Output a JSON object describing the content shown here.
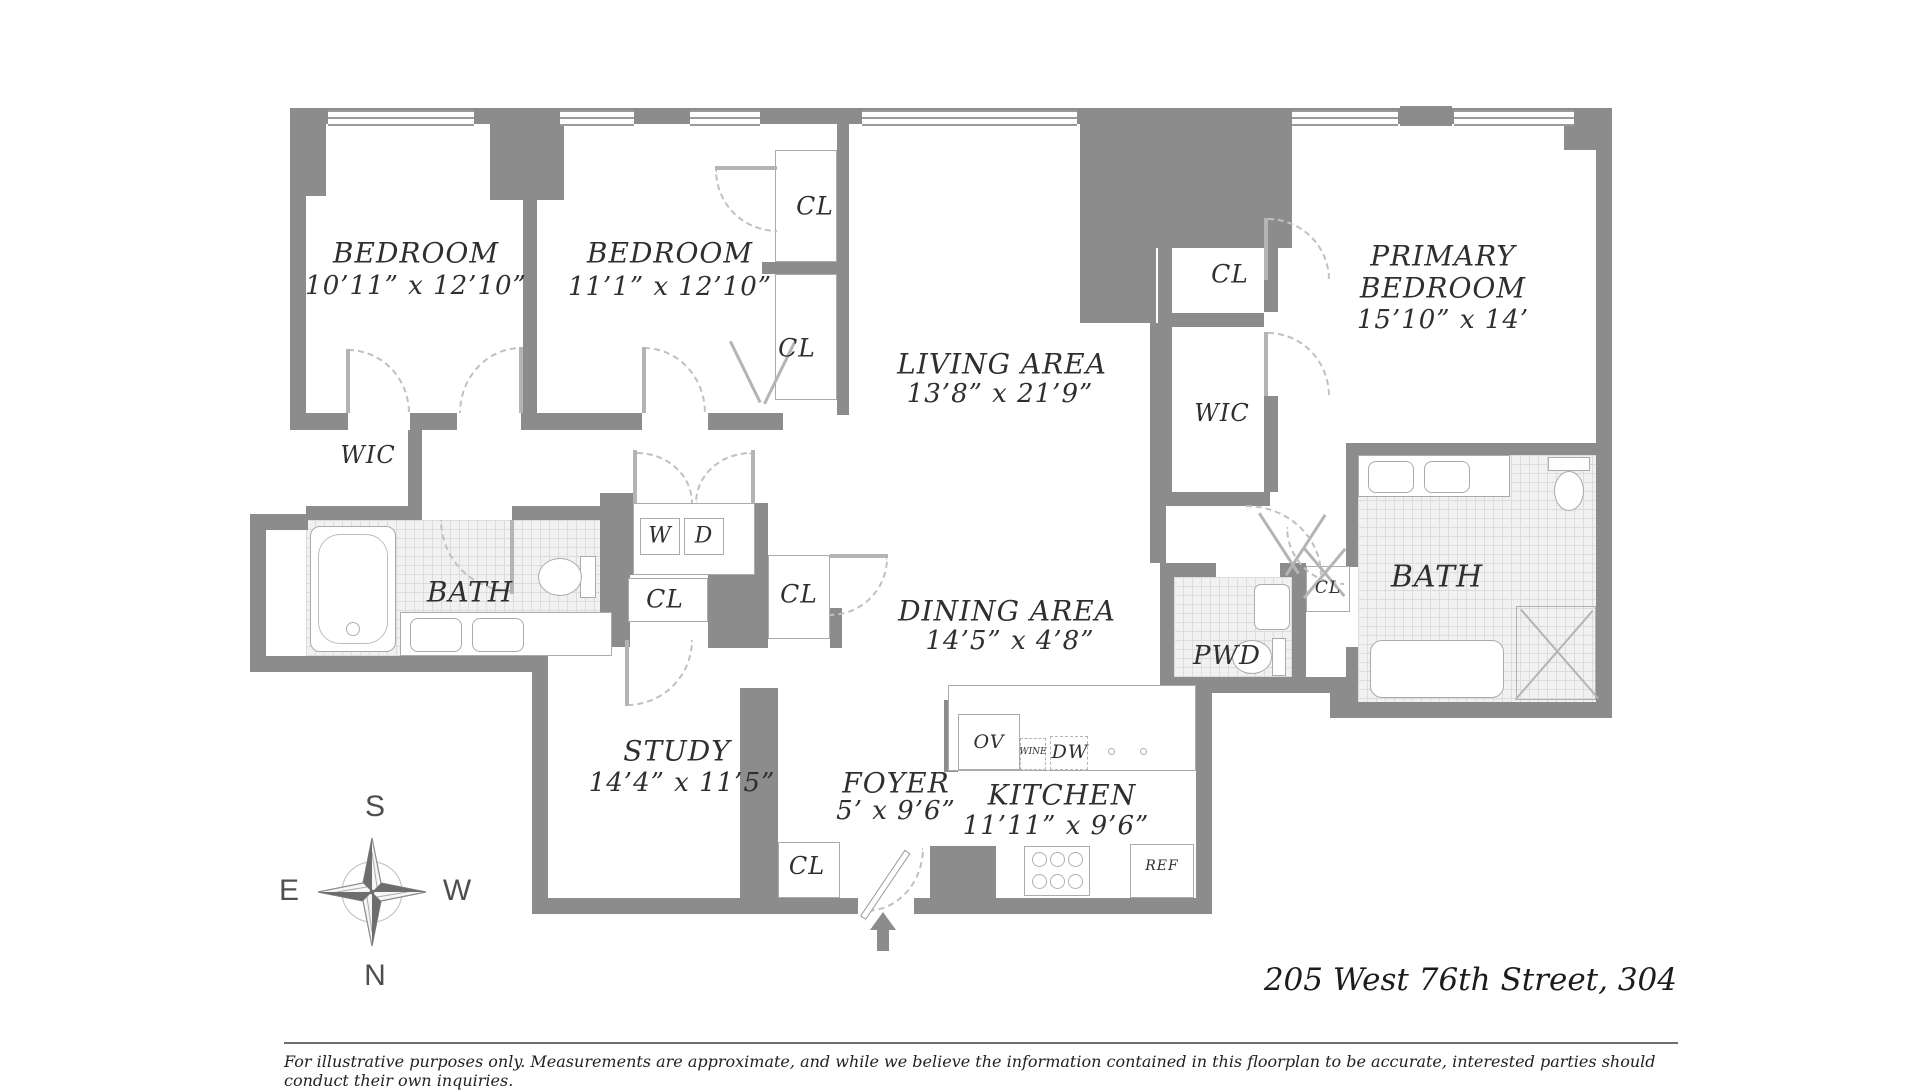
{
  "address": "205 West 76th Street, 304",
  "disclaimer": "For illustrative purposes only. Measurements are approximate, and while we believe the information contained in this floorplan to be accurate, interested parties should conduct their own inquiries.",
  "compass": {
    "north": "N",
    "south": "S",
    "east": "E",
    "west": "W"
  },
  "rooms": {
    "bedroom1": {
      "name": "BEDROOM",
      "dims": "10’11” x 12’10”"
    },
    "bedroom2": {
      "name": "BEDROOM",
      "dims": "11’1” x 12’10”"
    },
    "living_area": {
      "name": "LIVING AREA",
      "dims": "13’8” x 21’9”"
    },
    "primary_bedroom": {
      "name_line1": "PRIMARY",
      "name_line2": "BEDROOM",
      "dims": "15’10” x 14’"
    },
    "dining_area": {
      "name": "DINING AREA",
      "dims": "14’5” x 4’8”"
    },
    "study": {
      "name": "STUDY",
      "dims": "14’4” x 11’5”"
    },
    "foyer": {
      "name": "FOYER",
      "dims": "5’ x 9’6”"
    },
    "kitchen": {
      "name": "KITCHEN",
      "dims": "11’11” x 9’6”"
    },
    "bath": {
      "name": "BATH"
    },
    "powder_room": {
      "name": "PWD"
    },
    "walk_in_closet": {
      "name": "WIC"
    },
    "closet": {
      "name": "CL"
    }
  },
  "appliances": {
    "washer": "W",
    "dryer": "D",
    "oven": "OV",
    "wine_cooler": "WINE",
    "dishwasher": "DW",
    "refrigerator": "REF"
  }
}
